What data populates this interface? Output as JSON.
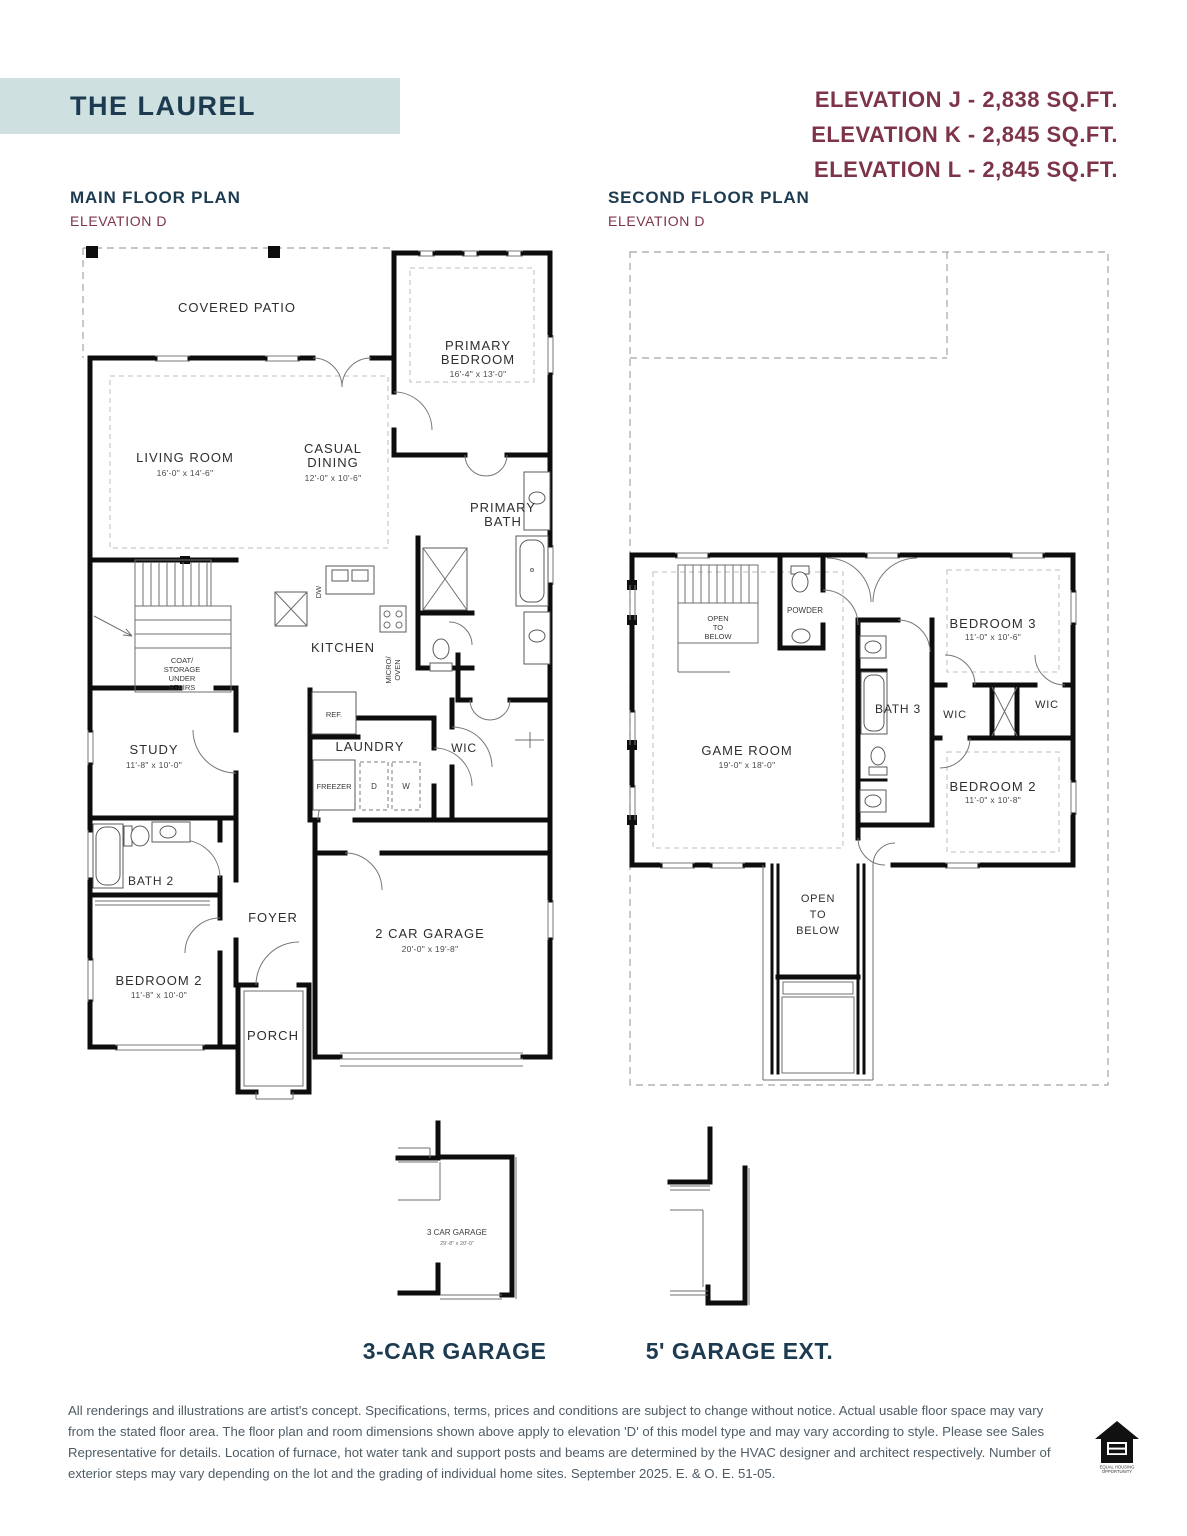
{
  "header": {
    "title": "THE LAUREL",
    "elevations": [
      "ELEVATION J - 2,838 SQ.FT.",
      "ELEVATION K - 2,845 SQ.FT.",
      "ELEVATION L - 2,845 SQ.FT."
    ]
  },
  "main_floor": {
    "heading": "MAIN FLOOR PLAN",
    "subheading": "ELEVATION D",
    "labels": {
      "covered_patio": "COVERED PATIO",
      "living_room": "LIVING ROOM",
      "living_room_dims": "16'-0\" x 14'-6\"",
      "casual_dining_line1": "CASUAL",
      "casual_dining_line2": "DINING",
      "casual_dining_dims": "12'-0\" x 10'-6\"",
      "primary_bedroom_line1": "PRIMARY",
      "primary_bedroom_line2": "BEDROOM",
      "primary_bedroom_dims": "16'-4\" x 13'-0\"",
      "primary_bath_line1": "PRIMARY",
      "primary_bath_line2": "BATH",
      "kitchen": "KITCHEN",
      "dw": "DW",
      "micro_oven_line1": "MICRO/",
      "micro_oven_line2": "OVEN",
      "ref": "REF.",
      "coat_line1": "COAT/",
      "coat_line2": "STORAGE",
      "coat_line3": "UNDER",
      "coat_line4": "STAIRS",
      "study": "STUDY",
      "study_dims": "11'-8\" x 10'-0\"",
      "laundry": "LAUNDRY",
      "freezer": "FREEZER",
      "dryer": "D",
      "washer": "W",
      "wic": "WIC",
      "bath2": "BATH 2",
      "bedroom2": "BEDROOM 2",
      "bedroom2_dims": "11'-8\" x 10'-0\"",
      "foyer": "FOYER",
      "porch": "PORCH",
      "garage": "2 CAR GARAGE",
      "garage_dims": "20'-0\" x 19'-8\""
    }
  },
  "second_floor": {
    "heading": "SECOND FLOOR PLAN",
    "subheading": "ELEVATION D",
    "labels": {
      "open_below_stairs_line1": "OPEN",
      "open_below_stairs_line2": "TO",
      "open_below_stairs_line3": "BELOW",
      "powder": "POWDER",
      "game_room": "GAME ROOM",
      "game_room_dims": "19'-0\" x 18'-0\"",
      "bedroom3": "BEDROOM 3",
      "bedroom3_dims": "11'-0\" x 10'-6\"",
      "bath3": "BATH 3",
      "wic_left": "WIC",
      "wic_right": "WIC",
      "bedroom2": "BEDROOM 2",
      "bedroom2_dims": "11'-0\" x 10'-8\"",
      "open_below_void_line1": "OPEN",
      "open_below_void_line2": "TO",
      "open_below_void_line3": "BELOW"
    }
  },
  "options": {
    "three_car_garage": {
      "plan_label": "3 CAR GARAGE",
      "plan_dims": "29'-8\" x 20'-0\"",
      "caption": "3-CAR GARAGE"
    },
    "garage_ext": {
      "caption": "5' GARAGE EXT."
    }
  },
  "footer": {
    "disclaimer": "All renderings and illustrations are artist's concept. Specifications, terms, prices and conditions are subject to change without notice. Actual usable floor space may vary from the stated floor area. The floor plan and room dimensions shown above apply to elevation 'D' of this model type and may vary according to style. Please see Sales Representative for details. Location of furnace, hot water tank and support posts and beams are determined by the HVAC designer and architect respectively. Number of exterior steps may vary depending on the lot and the grading of individual home sites. September 2025. E. & O. E. 51-05.",
    "equal_housing_line1": "EQUAL HOUSING",
    "equal_housing_line2": "OPPORTUNITY"
  },
  "colors": {
    "navy": "#1c3a50",
    "maroon": "#7d3448",
    "banner": "#cfe0e1"
  }
}
